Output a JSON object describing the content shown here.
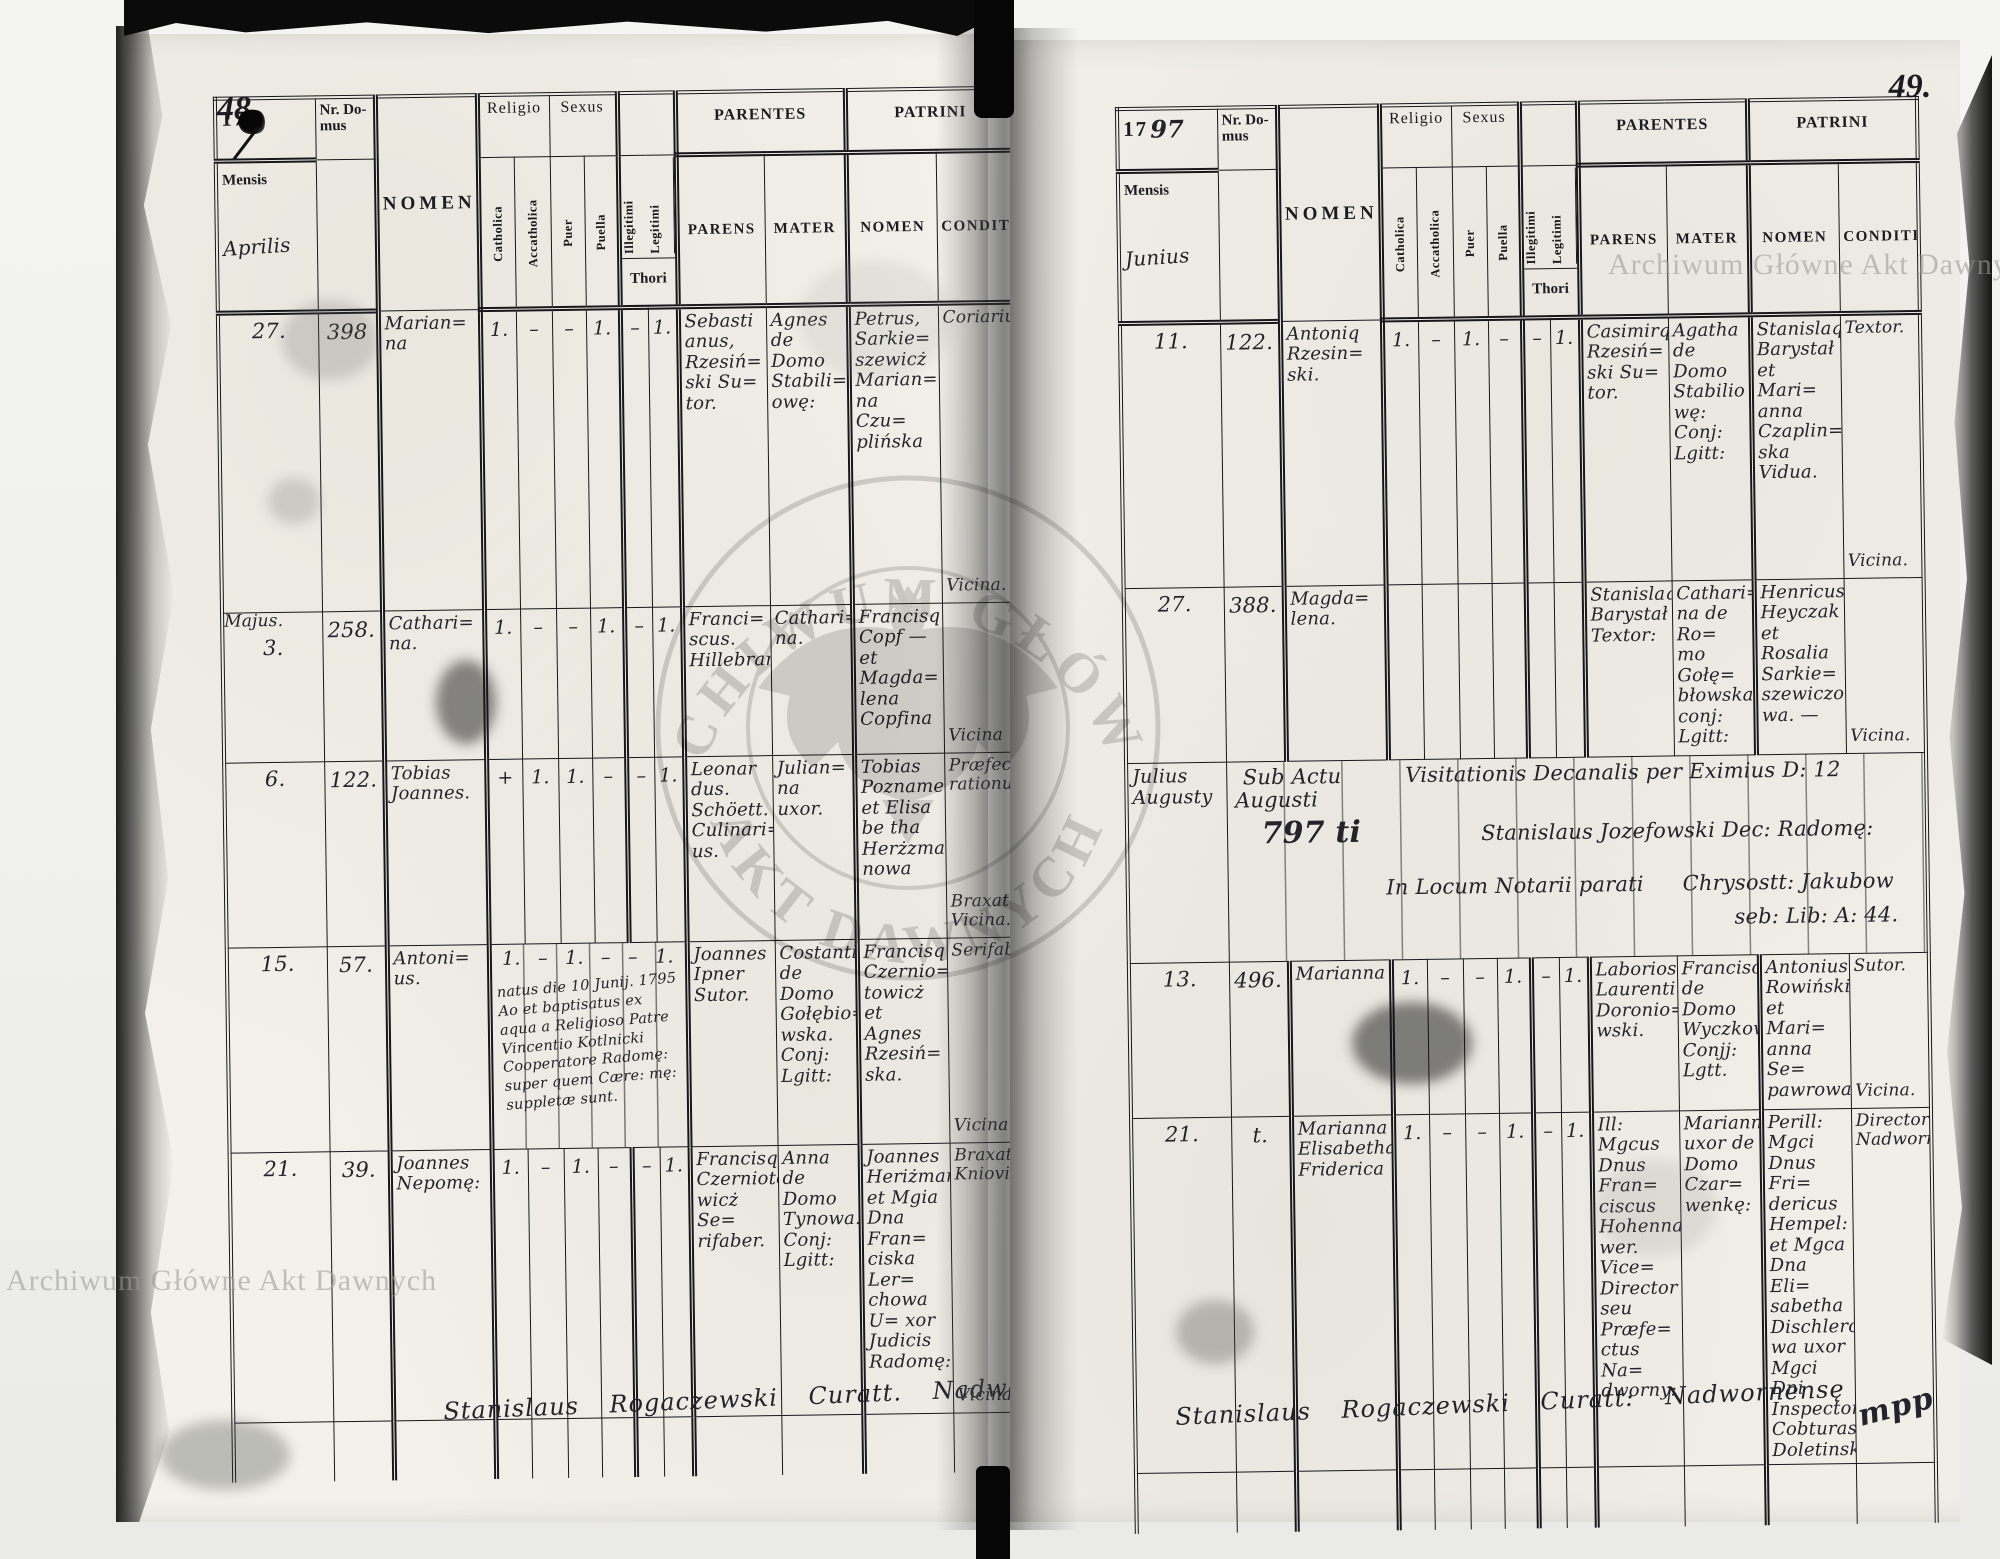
{
  "watermark": {
    "name": "Archiwum Główne Akt Dawnych",
    "seal_top": "ARCHIWUM GŁÓWNE",
    "seal_bottom": "AKT DAWNYCH"
  },
  "labels": {
    "year_prefix": "17",
    "nr_domus": "Nr. Do- mus",
    "mensis": "Mensis",
    "nomen": "NOMEN",
    "religio": "Religio",
    "sexus": "Sexus",
    "catholica": "Catholica",
    "accatholica": "Accatholica",
    "puer": "Puer",
    "puella": "Puella",
    "illegitimi": "Illegitimi",
    "legitimi": "Legitimi",
    "thori": "Thori",
    "parentes": "PARENTES",
    "parens": "PARENS",
    "mater": "MATER",
    "patrini": "PATRINI",
    "patrini_nomen": "NOMEN",
    "conditio": "CONDITIO"
  },
  "left": {
    "page_number": "48.",
    "year_script": "",
    "month": "Aprilis",
    "rows": [
      {
        "month_note": "",
        "date": "27.",
        "nr": "398",
        "nomen": "Marian= na",
        "marks": [
          "1.",
          "–",
          "–",
          "1.",
          "–",
          "1."
        ],
        "parens": "Sebasti anus, Rzesiń= ski Su= tor.",
        "mater": "Agnes de Domo Stabili= owę:",
        "patrini": "Petrus, Sarkie= szewicż Marian= na Czu= plińska",
        "cond_top": "Coriarius",
        "cond_bottom": "Vicina."
      },
      {
        "month_note": "Majus.",
        "date": "3.",
        "nr": "258.",
        "nomen": "Cathari= na.",
        "marks": [
          "1.",
          "–",
          "–",
          "1.",
          "–",
          "1."
        ],
        "parens": "Franci= scus. Hillebrand.",
        "mater": "Cathari= na.",
        "patrini": "Francisq Copf — et Magda= lena Copfina",
        "cond_top": "",
        "cond_bottom": "Vicina"
      },
      {
        "month_note": "",
        "date": "6.",
        "nr": "122.",
        "nomen": "Tobias Joannes.",
        "marks": [
          "+",
          "1.",
          "1.",
          "–",
          "–",
          "1."
        ],
        "parens": "Leonar dus. Schöett. Culinari= us.",
        "mater": "Julian= na uxor.",
        "patrini": "Tobias Poznamer et Elisa be tha Herżzma nowa",
        "cond_top": "Præfectus rationu:",
        "cond_bottom": "Braxatrix Vicina."
      },
      {
        "month_note": "",
        "date": "15.",
        "nr": "57.",
        "nomen": "Antoni= us.",
        "marks": [
          "1.",
          "–",
          "1.",
          "–",
          "–",
          "1."
        ],
        "note": "natus die 10 Junij. 1795 Ao et baptisatus ex aqua a Religioso Patre Vincentio Kotlnicki Cooperatore Radomę: super quem Cære: mę: suppletæ sunt.",
        "parens": "Joannes Ipner Sutor.",
        "mater": "Costantia de Domo Gołębio= wska. Conj: Lgitt:",
        "patrini": "Francisq Czernio= towicż et Agnes Rzesiń= ska.",
        "cond_top": "Serifaber.",
        "cond_bottom": "Vicina"
      },
      {
        "month_note": "",
        "date": "21.",
        "nr": "39.",
        "nomen": "Joannes Nepomę:",
        "marks": [
          "1.",
          "–",
          "1.",
          "–",
          "–",
          "1."
        ],
        "parens": "Francisq Czernioto= wicż Se= rifaber.",
        "mater": "Anna de Domo Tynowa. Conj: Lgitt:",
        "patrini": "Joannes Heriżman et Mgia Dna Fran= ciska Ler= chowa U= xor Judicis Radomę:",
        "cond_top": "Braxator Kniovien:",
        "cond_bottom": "Vicina."
      }
    ],
    "signature": "Stanislaus Rogaczewski Curatt. Nadwornę",
    "flourish": "mpp"
  },
  "right": {
    "page_number": "49.",
    "year_script": "97",
    "month": "Junius",
    "rows": [
      {
        "month_note": "",
        "date": "11.",
        "nr": "122.",
        "nomen": "Antoniq Rzesin= ski.",
        "marks": [
          "1.",
          "–",
          "1.",
          "–",
          "–",
          "1."
        ],
        "parens": "Casimirq Rzesiń= ski Su= tor.",
        "mater": "Agatha de Domo Stabilio wę: Conj: Lgitt:",
        "patrini": "Stanislaq Barystał et Mari= anna Czaplin= ska Vidua.",
        "cond_top": "Textor.",
        "cond_bottom": "Vicina."
      },
      {
        "month_note": "",
        "date": "27.",
        "nr": "388.",
        "nomen": "Magda= lena.",
        "marks": [
          "",
          "",
          "",
          "",
          "",
          ""
        ],
        "parens": "Stanislaq Barystał Textor:",
        "mater": "Cathari= na de Ro= mo Gołę= błowska conj: Lgitt:",
        "patrini": "Henricus Heyczak et Rosalia Sarkie= szewiczo= wa. —",
        "cond_top": "",
        "cond_bottom": "Vicina."
      },
      {
        "month_note": "",
        "date": "13.",
        "nr": "496.",
        "nomen": "Marianna",
        "marks": [
          "1.",
          "–",
          "–",
          "1.",
          "–",
          "1."
        ],
        "parens": "Laboriosq Laurentiq Doronio= wski.",
        "mater": "Franciscad de Domo Wyczkow Conjj: Lgtt.",
        "patrini": "Antonius Rowiński et Mari= anna Se= pawrowa",
        "cond_top": "Sutor.",
        "cond_bottom": "Vicina."
      },
      {
        "month_note": "",
        "date": "21.",
        "nr": "t.",
        "nomen": "Marianna Elisabetha Friderica",
        "marks": [
          "1.",
          "–",
          "–",
          "1.",
          "–",
          "1."
        ],
        "parens": "Ill: Mgcus Dnus Fran= ciscus Hohenna= wer. Vice= Director seu Præfe= ctus Na= dworny:",
        "mater": "Marianna uxor de Domo Czar= wenkę:",
        "patrini": "Perill: Mgci Dnus Fri= dericus Hempel: et Mgca Dna Eli= sabetha Dischlero= wa uxor Mgci Dni Inspectorę Cobturas Doletinsky:",
        "cond_top": "Director: Nadwornę:",
        "cond_bottom": ""
      }
    ],
    "visitation": {
      "months": "Julius Augusty",
      "line1a": "Sub Actu",
      "line1b": "Visitationis Decanalis per Eximius D: 12 Augusti",
      "line2a": "797 ti",
      "line2b": "Stanislaus Jozefowski Dec: Radomę:",
      "line3a": "In Locum Notarii parati",
      "line3b": "Chrysostt: Jakubow",
      "line4": "seb: Lib: A: 44."
    },
    "signature": "Stanislaus Rogaczewski Curatt: Nadwornensę",
    "flourish": "mpp"
  }
}
